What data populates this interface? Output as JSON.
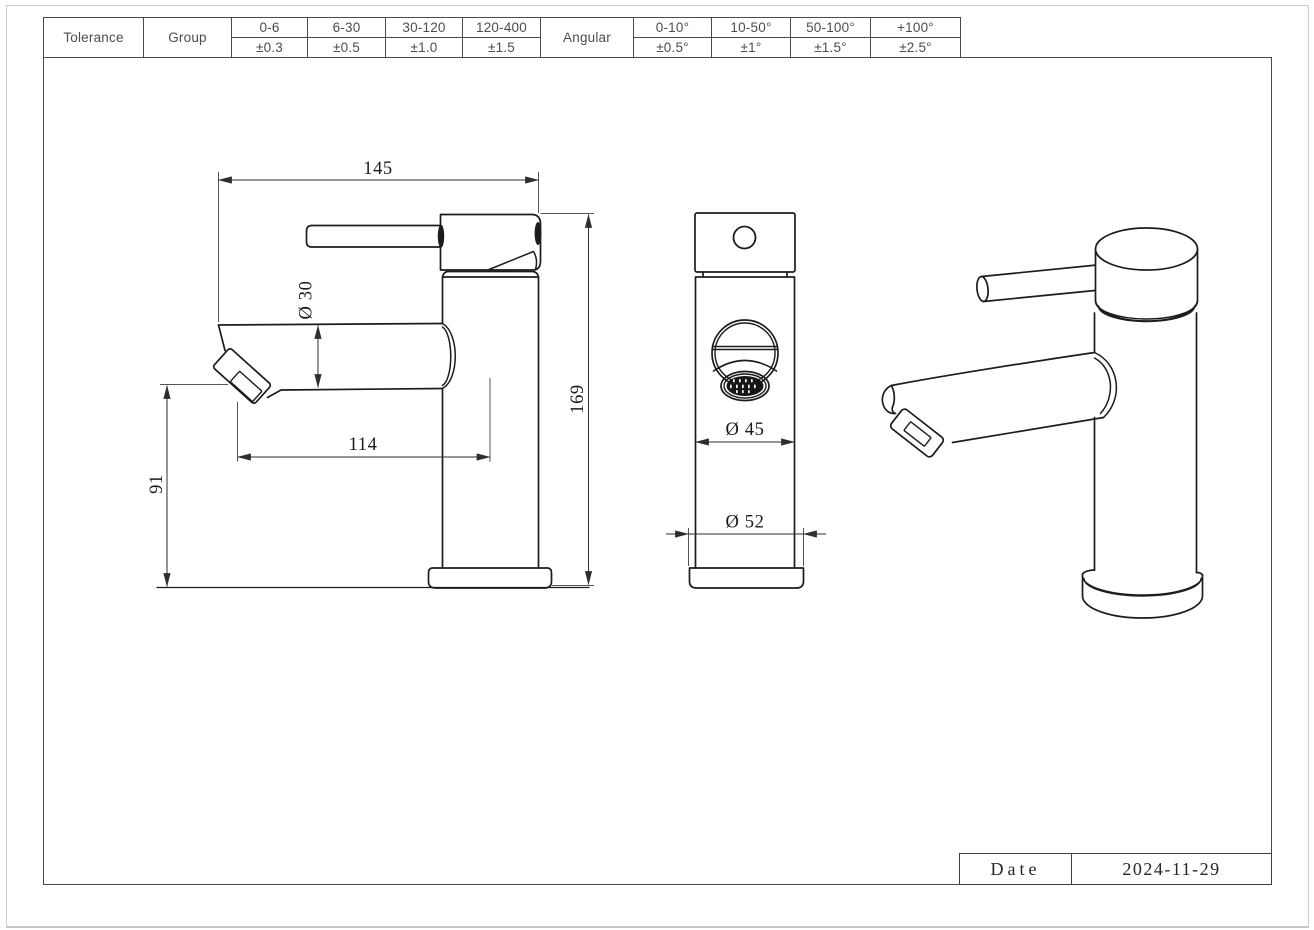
{
  "appearance": {
    "background": "#ffffff",
    "frame_color": "#4a4a4a",
    "object_line_color": "#1c1c1c",
    "dimension_line_color": "#2e2e2e"
  },
  "tolerance_table": {
    "tolerance_label": "Tolerance",
    "group_label": "Group",
    "angular_label": "Angular",
    "linear_ranges": [
      {
        "range": "0-6",
        "tolerance": "±0.3"
      },
      {
        "range": "6-30",
        "tolerance": "±0.5"
      },
      {
        "range": "30-120",
        "tolerance": "±1.0"
      },
      {
        "range": "120-400",
        "tolerance": "±1.5"
      }
    ],
    "angular_ranges": [
      {
        "range": "0-10°",
        "tolerance": "±0.5°"
      },
      {
        "range": "10-50°",
        "tolerance": "±1°"
      },
      {
        "range": "50-100°",
        "tolerance": "±1.5°"
      },
      {
        "range": "+100°",
        "tolerance": "±2.5°"
      }
    ]
  },
  "drawing": {
    "subject": "single-lever basin faucet, three views",
    "front_view": {
      "width_label": "145",
      "spout_diameter_label": "Ø 30",
      "reach_label": "114",
      "spout_height_label": "91",
      "height_label": "169"
    },
    "end_view": {
      "body_diameter_label": "Ø 45",
      "base_diameter_label": "Ø 52"
    }
  },
  "title_block": {
    "date_label": "Date",
    "date_value": "2024-11-29"
  }
}
